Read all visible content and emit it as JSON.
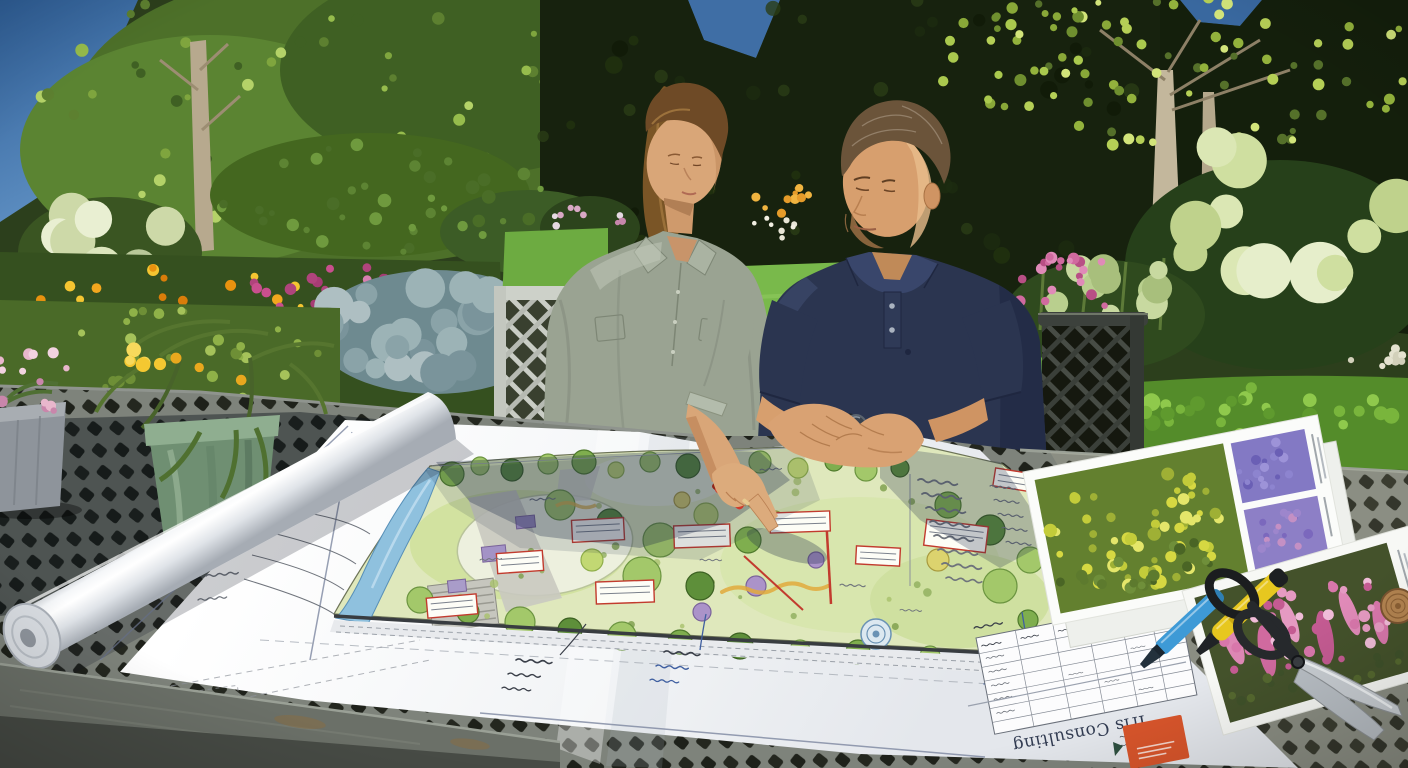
{
  "image": {
    "type": "photograph",
    "width": 1408,
    "height": 768,
    "description": "Sunlit garden patio: a woman in a sage-grey shirt and a man in a navy polo sit at a grey metal lattice table reviewing a large hand-drawn landscape masterplan; the woman points at the plan while holding a red pen. A rolled sheet, plant photo cards, two markers, garden shears and potted flowers rest on the table; lush flower borders, clipped hedges and a staked young tree fill the background."
  },
  "scene": {
    "people": [
      {
        "id": "woman",
        "hair": "long brown ponytail",
        "top": "sage-grey button-up shirt, sleeves rolled",
        "action": "pointing at plan, red pen in hand"
      },
      {
        "id": "man",
        "hair": "short brown with grey",
        "top": "navy polo shirt",
        "accessory": "dark wristwatch",
        "action": "hands clasped on plan edge"
      }
    ],
    "plan": {
      "kind": "hand-drawn colour-rendered landscape masterplan",
      "title_block_text": "Iris Consulting",
      "title_block_orientation": "upside-down to viewer",
      "logo_color": "#d8552b",
      "features": [
        "blue stream along left boundary",
        "circular lawns",
        "planting beds",
        "tree canopy symbols",
        "red annotation boxes",
        "leader-line notes",
        "plant schedule table",
        "hatched boundary strip"
      ]
    },
    "tabletop_items": [
      "rolled plan sheet",
      "plant photo card with yellow shrub and purple flower insets",
      "plant photo card with pink flower spikes",
      "blue marker",
      "yellow marker",
      "black-handled garden shears",
      "small wooden disc",
      "grey pot with pink flowers",
      "green pot with yellow daisies"
    ],
    "garden": [
      "dark clipped hedges",
      "bright leafy tree top left",
      "staked young tree top right",
      "white hydrangea mopheads",
      "blue-grey spruce",
      "orange and yellow flower border",
      "magenta and pink perennials",
      "sunlit boxwood hedge",
      "green lawn",
      "lime-green hydrangea border"
    ],
    "palette": {
      "sky": "#35669e",
      "hedge_dark": "#17220e",
      "foliage_bright": "#96bc4c",
      "lawn": "#79b94b",
      "boxwood": "#548c2a",
      "table_slat": "#7e837b",
      "table_gap": "#24271f",
      "paper": "#f8f9fb",
      "plan_bed": "#dfe8bc",
      "stream": "#8fc1de",
      "annotation_red": "#c23b2e",
      "annotation_blue": "#3f5fa0",
      "woman_shirt": "#9aa392",
      "man_polo": "#2b3550",
      "marker_blue": "#3e9ad6",
      "marker_yellow": "#e7c71f",
      "logo_orange": "#d8552b"
    }
  },
  "scene_geometry": {
    "tree_palette": [
      [
        "#7fae4e",
        "#4f7a2c"
      ],
      [
        "#a3c86a",
        "#6b9440"
      ],
      [
        "#5e8f3a",
        "#3c6122"
      ],
      [
        "#c2d873",
        "#8fae4a"
      ],
      [
        "#ab93c9",
        "#7a639a"
      ],
      [
        "#dcd36e",
        "#a89a3e"
      ],
      [
        "#6fa8a0",
        "#4a7d76"
      ]
    ],
    "plan_trees": [
      [
        452,
        474,
        12,
        1
      ],
      [
        480,
        466,
        9,
        2
      ],
      [
        512,
        470,
        11,
        3
      ],
      [
        548,
        464,
        10,
        2
      ],
      [
        584,
        462,
        12,
        1
      ],
      [
        616,
        470,
        8,
        4
      ],
      [
        650,
        462,
        10,
        2
      ],
      [
        688,
        466,
        12,
        3
      ],
      [
        724,
        470,
        9,
        1
      ],
      [
        760,
        462,
        11,
        2
      ],
      [
        798,
        468,
        10,
        4
      ],
      [
        834,
        462,
        9,
        1
      ],
      [
        866,
        470,
        11,
        2
      ],
      [
        900,
        468,
        9,
        3
      ],
      [
        560,
        505,
        15,
        2
      ],
      [
        610,
        522,
        13,
        3
      ],
      [
        660,
        540,
        17,
        2
      ],
      [
        706,
        515,
        12,
        4
      ],
      [
        748,
        540,
        13,
        1
      ],
      [
        642,
        576,
        19,
        2
      ],
      [
        700,
        586,
        14,
        3
      ],
      [
        592,
        560,
        11,
        4
      ],
      [
        775,
        520,
        9,
        6
      ],
      [
        682,
        500,
        8,
        6
      ],
      [
        948,
        505,
        13,
        1
      ],
      [
        990,
        530,
        15,
        3
      ],
      [
        1030,
        560,
        13,
        2
      ],
      [
        1064,
        586,
        11,
        5
      ],
      [
        1000,
        586,
        17,
        2
      ],
      [
        938,
        560,
        11,
        6
      ],
      [
        1028,
        620,
        10,
        1
      ],
      [
        420,
        600,
        13,
        2
      ],
      [
        468,
        612,
        11,
        1
      ],
      [
        520,
        622,
        15,
        2
      ],
      [
        570,
        630,
        12,
        3
      ],
      [
        622,
        636,
        14,
        2
      ],
      [
        680,
        642,
        12,
        1
      ],
      [
        740,
        646,
        13,
        3
      ],
      [
        800,
        650,
        10,
        2
      ],
      [
        858,
        652,
        12,
        1
      ],
      [
        930,
        656,
        10,
        2
      ],
      [
        756,
        586,
        10,
        5
      ],
      [
        816,
        560,
        8,
        5
      ],
      [
        702,
        612,
        9,
        5
      ]
    ],
    "red_boxes": [
      [
        520,
        562,
        46,
        20,
        -4
      ],
      [
        598,
        530,
        52,
        22,
        -3
      ],
      [
        702,
        536,
        56,
        22,
        -2
      ],
      [
        800,
        522,
        60,
        20,
        -2
      ],
      [
        956,
        536,
        62,
        26,
        7
      ],
      [
        878,
        556,
        44,
        18,
        3
      ],
      [
        625,
        592,
        58,
        22,
        -2
      ],
      [
        452,
        606,
        50,
        20,
        -5
      ],
      [
        1014,
        480,
        40,
        18,
        9
      ]
    ],
    "squiggles": [
      [
        238,
        505,
        1,
        -6,
        0
      ],
      [
        226,
        528,
        1,
        -6,
        0
      ],
      [
        214,
        552,
        1,
        -6,
        0
      ],
      [
        206,
        576,
        0.9,
        -6,
        0
      ],
      [
        198,
        600,
        0.8,
        -6,
        0
      ],
      [
        300,
        470,
        0.8,
        -8,
        0
      ],
      [
        340,
        452,
        0.7,
        -8,
        0
      ],
      [
        516,
        660,
        1,
        4,
        1
      ],
      [
        508,
        674,
        0.9,
        4,
        1
      ],
      [
        502,
        688,
        0.8,
        4,
        1
      ],
      [
        664,
        652,
        1,
        4,
        1
      ],
      [
        656,
        666,
        0.9,
        4,
        2
      ],
      [
        650,
        680,
        0.8,
        4,
        2
      ],
      [
        996,
        655,
        1,
        5,
        2
      ],
      [
        990,
        670,
        0.9,
        5,
        2
      ],
      [
        984,
        684,
        0.8,
        5,
        2
      ],
      [
        918,
        480,
        1.1,
        6,
        0
      ],
      [
        922,
        494,
        1.1,
        6,
        0
      ],
      [
        926,
        508,
        1.1,
        6,
        0
      ],
      [
        930,
        522,
        1.1,
        6,
        0
      ],
      [
        934,
        536,
        1.1,
        6,
        0
      ],
      [
        938,
        550,
        1.1,
        6,
        0
      ],
      [
        942,
        564,
        1.1,
        6,
        0
      ],
      [
        946,
        578,
        1,
        6,
        0
      ],
      [
        990,
        486,
        0.7,
        6,
        0
      ],
      [
        994,
        500,
        0.7,
        6,
        0
      ],
      [
        998,
        514,
        0.7,
        6,
        0
      ],
      [
        1002,
        528,
        0.7,
        6,
        0
      ],
      [
        1006,
        542,
        0.7,
        6,
        0
      ],
      [
        530,
        500,
        0.7,
        -4,
        0
      ],
      [
        760,
        470,
        0.6,
        -4,
        0
      ],
      [
        700,
        560,
        0.6,
        0,
        0
      ],
      [
        840,
        585,
        0.7,
        2,
        0
      ],
      [
        900,
        610,
        0.6,
        2,
        0
      ],
      [
        480,
        560,
        0.6,
        -4,
        0
      ],
      [
        1136,
        734,
        0.45,
        169,
        1
      ],
      [
        1130,
        744,
        0.4,
        169,
        1
      ]
    ],
    "speckle_clusters": [
      {
        "t": "g-canopy-left",
        "cx": 330,
        "cy": 110,
        "rx": 290,
        "ry": 140,
        "n": 70,
        "r0": 3,
        "r1": 7,
        "seed": 11,
        "cols": [
          "#7fa53e",
          "#96bc4c",
          "#b4d268",
          "#5d8030",
          "#3f6023"
        ]
      },
      {
        "t": "g-canopy-right",
        "cx": 1200,
        "cy": 60,
        "rx": 220,
        "ry": 100,
        "n": 70,
        "r0": 3,
        "r1": 6,
        "seed": 12,
        "cols": [
          "#93b23c",
          "#b5cf56",
          "#d2e47a",
          "#55702a"
        ]
      },
      {
        "t": "g-canopy-right",
        "cx": 1040,
        "cy": 55,
        "rx": 110,
        "ry": 68,
        "n": 30,
        "r0": 3,
        "r1": 6,
        "seed": 13,
        "cols": [
          "#89a838",
          "#aac94e",
          "#6f8f2f"
        ]
      },
      {
        "t": "g-hedge-tex",
        "cx": 860,
        "cy": 140,
        "rx": 320,
        "ry": 150,
        "n": 46,
        "r0": 4,
        "r1": 9,
        "seed": 14,
        "op": 0.8,
        "cols": [
          "#1d2c10",
          "#22330f",
          "#101a08",
          "#2a3d16"
        ]
      },
      {
        "t": "g-bushes-midleft",
        "cx": 380,
        "cy": 200,
        "rx": 170,
        "ry": 60,
        "n": 40,
        "r0": 3,
        "r1": 7,
        "seed": 15,
        "cols": [
          "#4a6d27",
          "#5d8433",
          "#6f9a3e"
        ]
      },
      {
        "t": "g-hydrangea-left",
        "cx": 105,
        "cy": 245,
        "rx": 75,
        "ry": 48,
        "n": 11,
        "r0": 12,
        "r1": 24,
        "seed": 16,
        "cols": [
          "#dce6bd",
          "#cdd9a8",
          "#e9efd2",
          "#b9c89a"
        ]
      },
      {
        "t": "g-orange-flowers",
        "cx": 170,
        "cy": 330,
        "rx": 160,
        "ry": 70,
        "n": 44,
        "r0": 2.5,
        "r1": 6,
        "seed": 17,
        "cols": [
          "#e8920f",
          "#f2a71e",
          "#f4c531",
          "#d97d0a"
        ]
      },
      {
        "t": "g-yellow-flowers",
        "cx": 425,
        "cy": 322,
        "rx": 60,
        "ry": 32,
        "n": 10,
        "r0": 4,
        "r1": 8,
        "seed": 18,
        "cols": [
          "#f3c93a",
          "#f7da5e",
          "#e8ae1f"
        ]
      },
      {
        "t": "g-pink-flowers",
        "cx": 340,
        "cy": 300,
        "rx": 110,
        "ry": 34,
        "n": 30,
        "r0": 2.5,
        "r1": 6,
        "seed": 19,
        "cols": [
          "#c94f8e",
          "#b0447c",
          "#d97fb0",
          "#a63c74"
        ]
      },
      {
        "t": "g-white-flowers",
        "cx": 30,
        "cy": 390,
        "rx": 34,
        "ry": 38,
        "n": 14,
        "r0": 2,
        "r1": 4.5,
        "seed": 20,
        "cols": [
          "#ece7d9",
          "#f4f0e4",
          "#d8d2c0"
        ]
      },
      {
        "t": "g-spruce",
        "cx": 435,
        "cy": 330,
        "rx": 112,
        "ry": 56,
        "n": 26,
        "r0": 10,
        "r1": 20,
        "seed": 21,
        "cols": [
          "#8aa3a8",
          "#9cb3b6",
          "#7a949b",
          "#aebfc2"
        ]
      },
      {
        "t": "g-spires",
        "cx": 590,
        "cy": 225,
        "rx": 45,
        "ry": 28,
        "n": 16,
        "r0": 2,
        "r1": 4,
        "seed": 22,
        "cols": [
          "#d8a8c4",
          "#e6d9e2",
          "#c786ab"
        ]
      },
      {
        "t": "g-orange-behind",
        "cx": 782,
        "cy": 198,
        "rx": 28,
        "ry": 16,
        "n": 10,
        "r0": 2.5,
        "r1": 5,
        "seed": 23,
        "cols": [
          "#e59b2a",
          "#f0b440"
        ]
      },
      {
        "t": "g-white-behind",
        "cx": 778,
        "cy": 228,
        "rx": 26,
        "ry": 12,
        "n": 8,
        "r0": 2,
        "r1": 4,
        "seed": 24,
        "cols": [
          "#e8e5d6",
          "#f2efe2"
        ]
      },
      {
        "t": "g-pink-behind",
        "cx": 1062,
        "cy": 285,
        "rx": 52,
        "ry": 38,
        "n": 20,
        "r0": 3,
        "r1": 6,
        "seed": 25,
        "cols": [
          "#d06a9f",
          "#e08ab8",
          "#b84f85"
        ]
      },
      {
        "t": "g-hydrangea-right",
        "cx": 1280,
        "cy": 220,
        "rx": 125,
        "ry": 85,
        "n": 11,
        "r0": 16,
        "r1": 34,
        "seed": 26,
        "cols": [
          "#cfdfa0",
          "#dbe7b4",
          "#bfd28c",
          "#e6eecb"
        ]
      },
      {
        "t": "g-sedum",
        "cx": 1105,
        "cy": 300,
        "rx": 85,
        "ry": 42,
        "n": 12,
        "r0": 8,
        "r1": 16,
        "seed": 27,
        "cols": [
          "#b9cf8e",
          "#c8d9a0",
          "#a8bf7c"
        ]
      },
      {
        "t": "g-box-left-hl",
        "cx": 520,
        "cy": 446,
        "rx": 210,
        "ry": 18,
        "n": 26,
        "r0": 3,
        "r1": 7,
        "seed": 28,
        "cols": [
          "#6ba335",
          "#7cb23e",
          "#548c2a"
        ]
      },
      {
        "t": "g-box-right-hl",
        "cx": 1230,
        "cy": 412,
        "rx": 175,
        "ry": 26,
        "n": 30,
        "r0": 4,
        "r1": 9,
        "seed": 29,
        "cols": [
          "#79b53c",
          "#8fc94c",
          "#5f9a2e"
        ]
      },
      {
        "t": "g-shrubs-pots",
        "cx": 160,
        "cy": 360,
        "rx": 160,
        "ry": 50,
        "n": 36,
        "r0": 2.5,
        "r1": 6,
        "seed": 30,
        "cols": [
          "#8fb148",
          "#a5c25a",
          "#6e8f36"
        ]
      },
      {
        "t": "g-white-far-right",
        "cx": 1372,
        "cy": 352,
        "rx": 38,
        "ry": 24,
        "n": 10,
        "r0": 2.5,
        "r1": 5,
        "seed": 31,
        "cols": [
          "#e4e2cf",
          "#d2d0ba"
        ]
      },
      {
        "t": "g-plan-scrub",
        "cx": 720,
        "cy": 560,
        "rx": 290,
        "ry": 95,
        "n": 34,
        "r0": 2,
        "r1": 4.5,
        "seed": 32,
        "op": 0.8,
        "cols": [
          "#8fae5c",
          "#7a9c48",
          "#a8c06c"
        ]
      },
      {
        "t": "g-daisies",
        "cx": 225,
        "cy": 358,
        "rx": 100,
        "ry": 26,
        "n": 10,
        "r0": 4.5,
        "r1": 7.5,
        "seed": 33,
        "cols": [
          "#f4c831",
          "#f7d95c",
          "#e9a81e"
        ]
      },
      {
        "t": "g-pinkpot",
        "cx": 32,
        "cy": 382,
        "rx": 42,
        "ry": 34,
        "n": 13,
        "r0": 3,
        "r1": 6,
        "seed": 34,
        "cols": [
          "#e8b7cc",
          "#f2d3e0",
          "#c986ab"
        ]
      },
      {
        "t": "g-photoA-yellow",
        "cx": -45,
        "cy": -2,
        "rx": 92,
        "ry": 60,
        "n": 60,
        "r0": 3,
        "r1": 7,
        "seed": 35,
        "cols": [
          "#d6d842",
          "#e4e66a",
          "#c3cc3a",
          "#9fb035"
        ]
      },
      {
        "t": "g-photoA-green",
        "cx": -45,
        "cy": 42,
        "rx": 92,
        "ry": 22,
        "n": 20,
        "r0": 3,
        "r1": 6,
        "seed": 36,
        "cols": [
          "#5d7a2e",
          "#6f8f3a",
          "#4a6525"
        ]
      },
      {
        "t": "g-photoA-p1",
        "cx": 96,
        "cy": -36,
        "rx": 34,
        "ry": 24,
        "n": 16,
        "r0": 2.5,
        "r1": 5,
        "seed": 37,
        "cols": [
          "#8d84cf",
          "#6a5fb5",
          "#9d93d8"
        ]
      },
      {
        "t": "g-photoA-p2",
        "cx": 96,
        "cy": 32,
        "rx": 34,
        "ry": 24,
        "n": 16,
        "r0": 2.5,
        "r1": 5,
        "seed": 38,
        "cols": [
          "#9d86cc",
          "#7b68bd",
          "#c490c4"
        ]
      },
      {
        "t": "g-photoB-tex",
        "cx": -15,
        "cy": -5,
        "rx": 92,
        "ry": 50,
        "n": 40,
        "r0": 3,
        "r1": 6,
        "seed": 39,
        "cols": [
          "#e59ac2",
          "#d877ab",
          "#c45b92",
          "#f0bcd8"
        ]
      },
      {
        "t": "g-photoB-green",
        "cx": -15,
        "cy": 45,
        "rx": 96,
        "ry": 16,
        "n": 16,
        "r0": 3,
        "r1": 5,
        "seed": 40,
        "cols": [
          "#3f512a",
          "#55682f"
        ]
      }
    ]
  }
}
